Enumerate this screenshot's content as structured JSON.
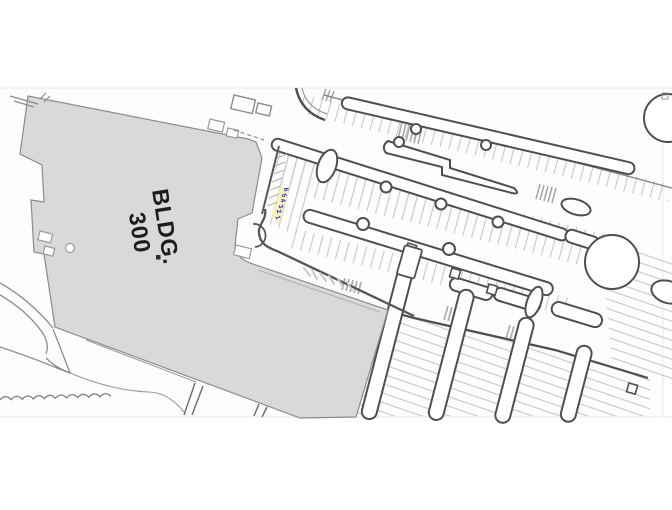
{
  "plan": {
    "title": "Site plan - Building 300 and parking lot"
  },
  "building": {
    "label_line1": "BLDG.",
    "label_line2": "300",
    "fill": "#d9d9d9",
    "outline": "#8c8c8c"
  },
  "stall_numbers": {
    "values": [
      "6",
      "5",
      "4",
      "3",
      "2",
      "1"
    ],
    "color": "#2a2ac4",
    "highlight": "#f8f0b0"
  },
  "colors": {
    "sheet_bg": "#fcfcfc",
    "sheet_edge": "#e9e9e9",
    "line_dark": "#4f4f4f",
    "line_medium": "#8c8c8c",
    "line_light": "#bdbdbd",
    "tick": "#c6c6c6"
  }
}
